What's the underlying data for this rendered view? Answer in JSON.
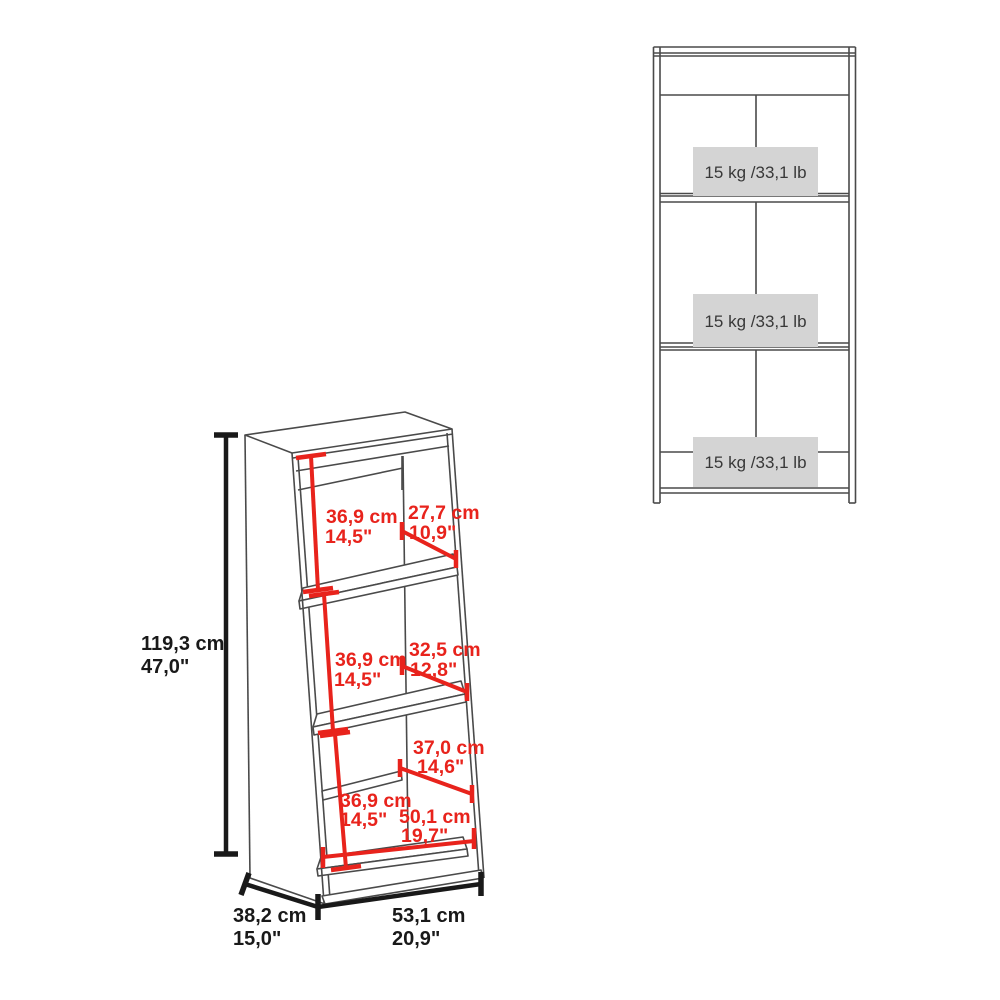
{
  "colors": {
    "dimension_red": "#e8231c",
    "dimension_black": "#191919",
    "outline_gray": "#4a4a4a",
    "capacity_box_bg": "#d4d4d4",
    "background": "#ffffff"
  },
  "perspective_view": {
    "height_total": {
      "cm": "119,3 cm",
      "inches": "47,0\""
    },
    "depth_total": {
      "cm": "38,2 cm",
      "inches": "15,0\""
    },
    "width_total": {
      "cm": "53,1 cm",
      "inches": "20,9\""
    },
    "compartments": [
      {
        "inner_height_cm": "36,9 cm",
        "inner_height_in": "14,5\"",
        "inner_depth_cm": "27,7 cm",
        "inner_depth_in": "10,9\""
      },
      {
        "inner_height_cm": "36,9 cm",
        "inner_height_in": "14,5\"",
        "inner_depth_cm": "32,5 cm",
        "inner_depth_in": "12,8\""
      },
      {
        "inner_height_cm": "36,9 cm",
        "inner_height_in": "14,5\"",
        "inner_depth_cm": "37,0 cm",
        "inner_depth_in": "14,6\"",
        "inner_width_cm": "50,1 cm",
        "inner_width_in": "19,7\""
      }
    ]
  },
  "front_view": {
    "shelf_capacities": [
      "15 kg /33,1 lb",
      "15 kg /33,1 lb",
      "15 kg /33,1 lb"
    ]
  }
}
